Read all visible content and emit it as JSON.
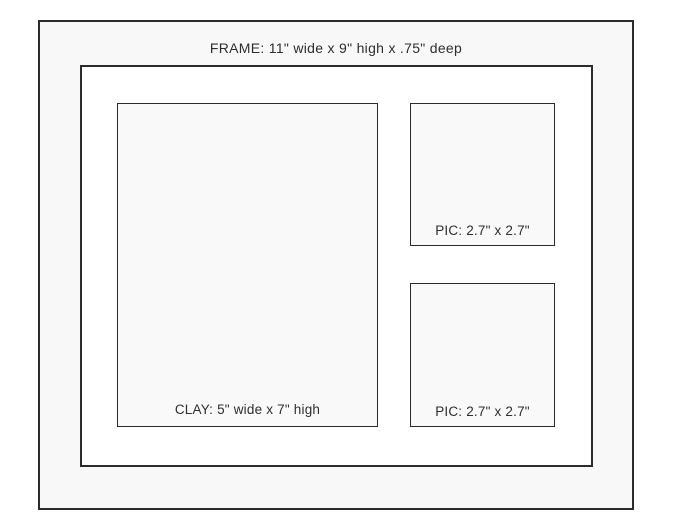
{
  "diagram": {
    "frame_label": "FRAME: 11\" wide x 9\" high x .75\" deep",
    "clay_label": "CLAY: 5\" wide x 7\" high",
    "pic_top_label": "PIC: 2.7\" x 2.7\"",
    "pic_bottom_label": "PIC: 2.7\" x 2.7\"",
    "colors": {
      "outline": "#2b2b2b",
      "frame_fill": "#f8f8f8",
      "mat_fill": "#ffffff",
      "opening_fill": "#f9f9f9",
      "text": "#2e2e2e"
    }
  }
}
